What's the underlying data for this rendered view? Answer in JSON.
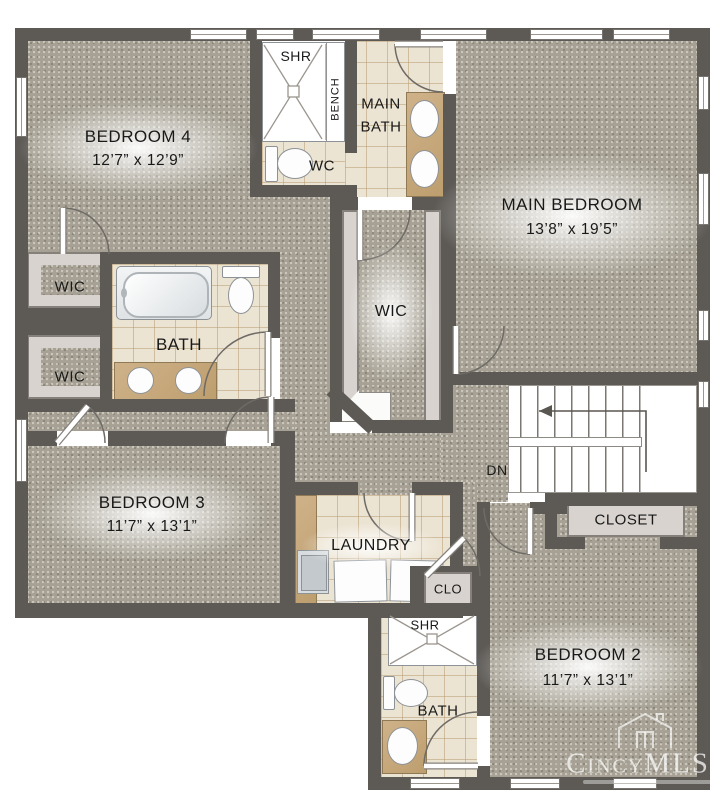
{
  "title": "Second floor residential floor plan",
  "labels": {
    "bedroom4_name": "BEDROOM 4",
    "bedroom4_dims": "12’7” x 12’9”",
    "main_bedroom_name": "MAIN BEDROOM",
    "main_bedroom_dims": "13’8” x 19’5”",
    "bedroom3_name": "BEDROOM 3",
    "bedroom3_dims": "11’7” x 13’1”",
    "bedroom2_name": "BEDROOM 2",
    "bedroom2_dims": "11’7” x 13’1”",
    "main_bath_line1": "MAIN",
    "main_bath_line2": "BATH",
    "bath_upper": "BATH",
    "bath_lower": "BATH",
    "wic_left_upper": "WIC",
    "wic_left_lower": "WIC",
    "wic_main": "WIC",
    "wc": "WC",
    "shr_top": "SHR",
    "shr_bottom": "SHR",
    "bench": "BENCH",
    "laundry": "LAUNDRY",
    "closet_stairs": "CLOSET",
    "clo": "CLO",
    "dn": "DN"
  },
  "watermark": {
    "brand": "CincyMLS"
  },
  "colors": {
    "wall": "#5d5a56",
    "carpet": "#a6a194",
    "tile": "#ece4d3",
    "counter": "#c7a97c",
    "shelf": "#d8d3cf",
    "background": "#ffffff"
  }
}
